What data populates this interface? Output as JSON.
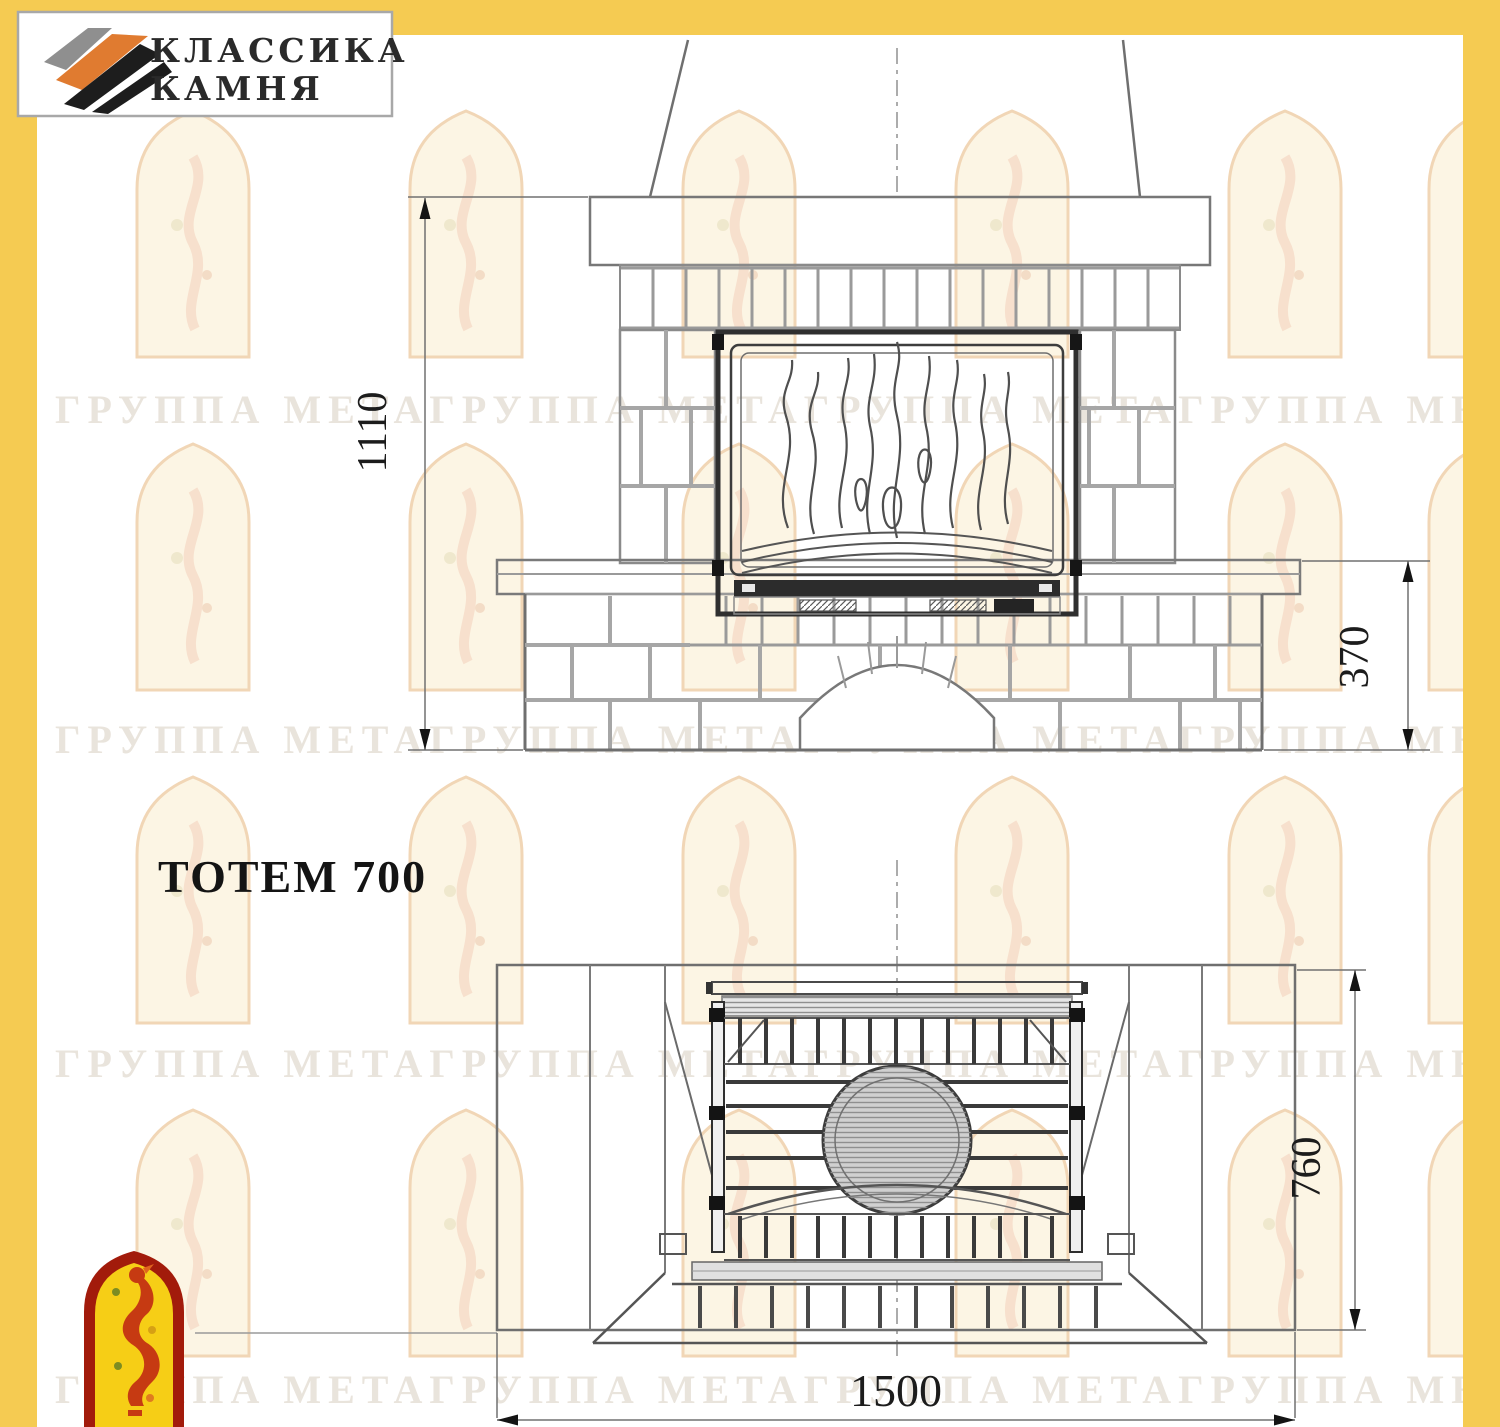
{
  "page": {
    "width": 1500,
    "height": 1427
  },
  "colors": {
    "page_bg": "#ffffff",
    "border_yellow": "#f5cb52",
    "drawing_line": "#6f6f6f",
    "insert_frame": "#2f2f2f",
    "brand_orange": "#e07b30",
    "firebird_red": "#a21b0b",
    "firebird_yellow": "#f6ce16",
    "watermark_text_color": "#d8cec0"
  },
  "brand": {
    "line1": "КЛАССИКА",
    "line2": "КАМНЯ"
  },
  "product": {
    "label": "ТОТЕМ 700"
  },
  "watermark": {
    "text": "ГРУППА МЕТАГРУППА МЕТАГРУППА МЕТАГРУППА МЕТА"
  },
  "front_view": {
    "name": "front elevation of fireplace",
    "dim_height_total": "1110",
    "dim_height_base": "370"
  },
  "plan_view": {
    "name": "plan view of fireplace",
    "dim_depth": "760",
    "dim_width": "1500"
  }
}
